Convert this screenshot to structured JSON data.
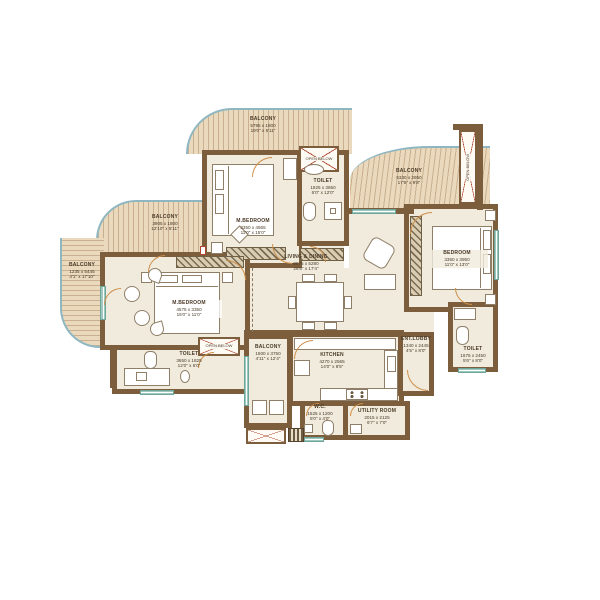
{
  "plan_type": "apartment-floor-plan",
  "rooms": [
    {
      "name": "BALCONY",
      "dim_mm": "5795 x 1800",
      "dim_ft": "19'0\" x 5'11\""
    },
    {
      "name": "M.BEDROOM",
      "dim_mm": "3350 x 4565",
      "dim_ft": "11'0\" x 15'0\""
    },
    {
      "name": "TOILET",
      "dim_mm": "1825 x 3650",
      "dim_ft": "6'0\" x 12'0\""
    },
    {
      "name": "BALCONY",
      "dim_mm": "5330 x 2950",
      "dim_ft": "17'6\" x 9'8\""
    },
    {
      "name": "BEDROOM",
      "dim_mm": "3350 x 3950",
      "dim_ft": "11'0\" x 13'0\""
    },
    {
      "name": "BALCONY",
      "dim_mm": "3905 x 1800",
      "dim_ft": "12'10\" x 5'11\""
    },
    {
      "name": "BALCONY",
      "dim_mm": "1235 x 5445",
      "dim_ft": "4'1\" x 17'10\""
    },
    {
      "name": "M.BEDROOM",
      "dim_mm": "4575 x 3350",
      "dim_ft": "15'0\" x 11'0\""
    },
    {
      "name": "LIVING & DINING",
      "dim_mm": "8075 x 5280",
      "dim_ft": "26'6\" x 17'4\""
    },
    {
      "name": "TOILET",
      "dim_mm": "3650 x 1825",
      "dim_ft": "12'0\" x 6'0\""
    },
    {
      "name": "BALCONY",
      "dim_mm": "1500 x 3750",
      "dim_ft": "4'11\" x 12'4\""
    },
    {
      "name": "KITCHEN",
      "dim_mm": "4270 x 2565",
      "dim_ft": "14'0\" x 8'5\""
    },
    {
      "name": "W.C.",
      "dim_mm": "1525 x 1200",
      "dim_ft": "5'0\" x 4'0\""
    },
    {
      "name": "UTILITY ROOM",
      "dim_mm": "2015 x 2125",
      "dim_ft": "6'7\" x 7'0\""
    },
    {
      "name": "ENT.LOBBY",
      "dim_mm": "1340 x 2445",
      "dim_ft": "4'5\" x 8'0\""
    },
    {
      "name": "TOILET",
      "dim_mm": "1675 x 2450",
      "dim_ft": "5'6\" x 8'0\""
    }
  ],
  "annotations": {
    "open_below_1": "OPEN BELOW",
    "open_below_2": "OPEN BELOW",
    "open_below_3": "OPEN BELOW"
  },
  "colors": {
    "wall": "#7d5e3c",
    "room_floor": "#f0ebdc",
    "deck_wood": "#ead9bd",
    "balcony_edge_blue": "#8fb7c2",
    "cross_red": "#b0442f",
    "window_teal": "#9ec7bd",
    "door_arc": "#cf8e49",
    "label_text": "#4a3a28"
  }
}
